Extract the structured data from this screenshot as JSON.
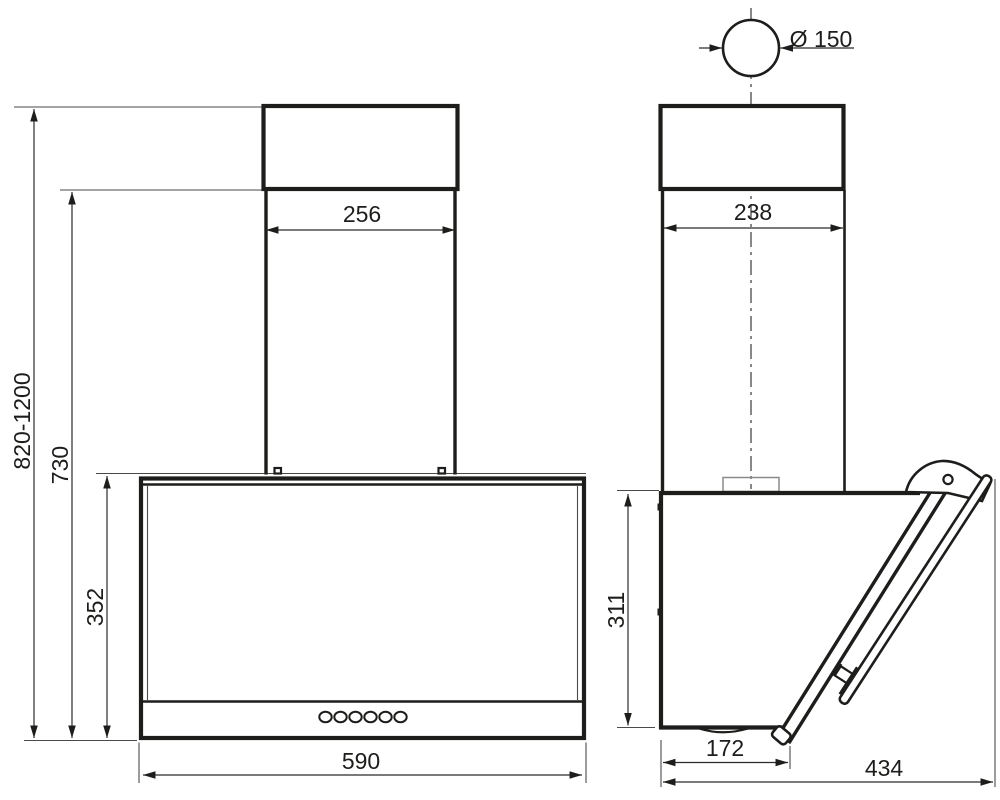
{
  "page": {
    "title": "Cooker hood installation drawing",
    "background_color": "#ffffff",
    "line_color": "#1d1d1b"
  },
  "front_view": {
    "label": "front view",
    "dimensions": {
      "mount_height_range_mm": "820-1200",
      "floor_to_chimney_joint_mm": "730",
      "body_height_mm": "352",
      "chimney_width_mm": "256",
      "body_width_mm": "590"
    },
    "controls": {
      "button_count": 6
    }
  },
  "side_view": {
    "label": "side view",
    "dimensions": {
      "duct_diameter_mm": "Ø 150",
      "chimney_depth_mm": "238",
      "rear_height_mm": "311",
      "bottom_depth_mm": "172",
      "total_depth_mm": "434"
    }
  }
}
